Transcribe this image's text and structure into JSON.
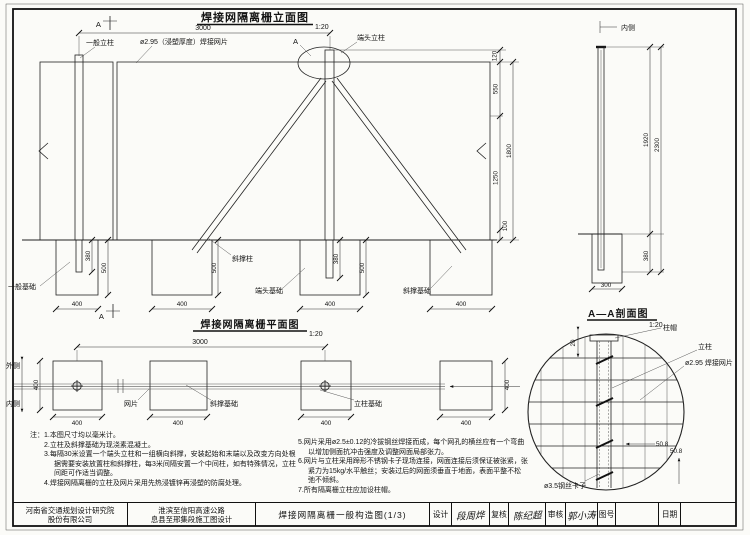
{
  "colors": {
    "paper": "#fbfbf8",
    "ink": "#222222"
  },
  "elevation": {
    "title": "焊接网隔离栅立面图",
    "scale": "1:20",
    "dim_span": "3000",
    "section_mark_top": "A",
    "section_mark_bottom": "A",
    "label_general_post": "一般立柱",
    "label_mesh": "ø2.95（浸塑厚度）焊接网片",
    "label_end_post": "端头立柱",
    "label_detail_a": "A",
    "dim_cap": "120",
    "dim_upper": "550",
    "dim_lower": "1250",
    "dim_total": "1800",
    "dim_ground_gap": "100",
    "label_brace_post": "斜撑柱",
    "label_general_foundation": "一般基础",
    "label_end_foundation": "端头基础",
    "label_brace_foundation": "斜撑基础",
    "dim_embed": "380",
    "dim_found_depth": "500",
    "dim_found_width": "400"
  },
  "side_view": {
    "label_inner": "内侧",
    "dim_above_ground": "1920",
    "dim_total": "2300",
    "dim_embed": "380",
    "dim_found_width": "300"
  },
  "plan": {
    "title": "焊接网隔离栅平面图",
    "scale": "1:20",
    "dim_span": "3000",
    "label_outer": "外侧",
    "label_inner": "内侧",
    "label_mesh": "网片",
    "label_brace_foundation": "斜撑基础",
    "label_post_foundation": "立柱基础",
    "dim_width": "400"
  },
  "detail": {
    "title": "A—A剖面图",
    "scale": "1:20",
    "label_cap": "柱帽",
    "label_post": "立柱",
    "label_mesh": "ø2.95 焊接网片",
    "label_clip": "ø3.5钢丝卡子",
    "dim_cap": "20",
    "dim_h": "50.8",
    "dim_v": "50.8"
  },
  "notes": {
    "heading": "注：",
    "items_left": [
      "1.本图尺寸均以毫米计。",
      "2.立柱及斜撑基础为现浇素混凝土。",
      "3.每隔30米设置一个端头立柱和一组横向斜撑，安装起始和末端以及改变方向处根据需要安装放置柱和斜撑柱，每3米间隔安置一个中间柱，如有特殊情况，立柱间距可作适当调整。",
      "4.焊接网隔离栅的立柱及网片采用先热浸镀锌再浸塑的防腐处理。"
    ],
    "items_right": [
      "5.网片采用ø2.5±0.12的冷拔钢丝焊接而成，每个网孔的横丝应有一个弯曲以增加侧面抗冲击强度及调整网面局部张力。",
      "6.网片与立柱采用蹄形不锈钢卡子现场连接，网面连接后须保证被张紧，张紧力为15kg/水平触丝；安装过后的网面须垂直于地面，表面平整不松弛不倾斜。",
      "7.所有隔离栅立柱应加设柱帽。"
    ]
  },
  "titleblock": {
    "company_line1": "河南省交通规划设计研究院",
    "company_line2": "股份有限公司",
    "project_line1": "淮滨至信阳高速公路",
    "project_line2": "息县至邢集段施工图设计",
    "drawing_title": "焊接网隔离栅一般构造图(1/3)",
    "field_design": "设计",
    "sig_design": "段周烨",
    "field_check": "复核",
    "sig_check": "陈纪超",
    "field_review": "审核",
    "sig_review": "郭小涛",
    "field_no": "图号",
    "field_date": "日期"
  }
}
